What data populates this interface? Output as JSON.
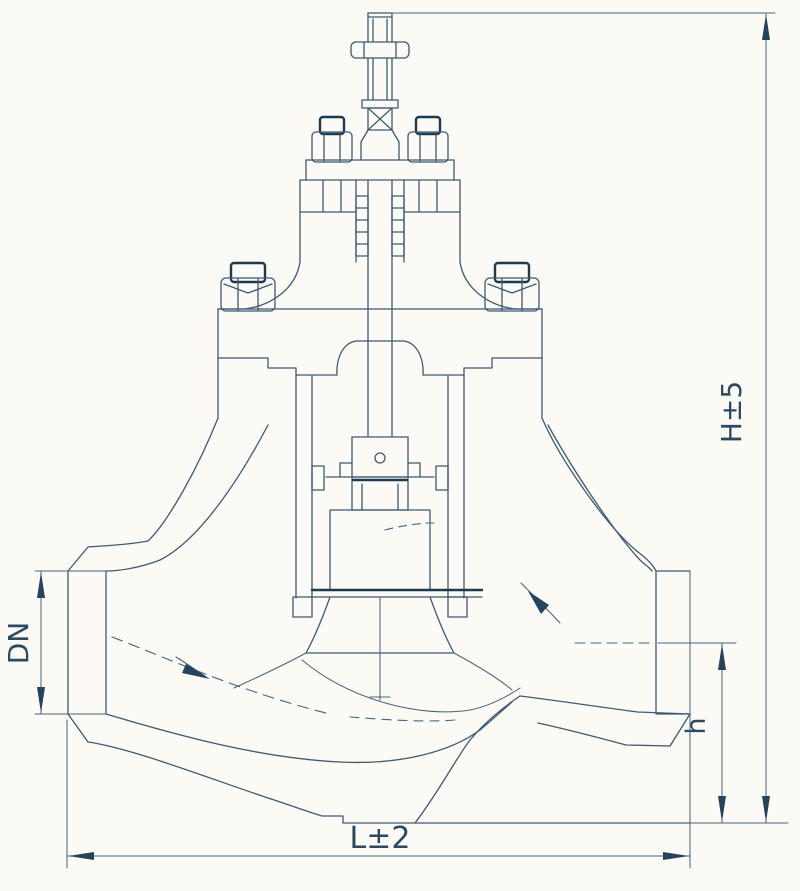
{
  "drawing": {
    "type": "globe-control-valve-cross-section",
    "dimension_labels": {
      "overall_height": "H±5",
      "outlet_center_height": "h",
      "nominal_diameter": "DN",
      "face_to_face_length": "L±2"
    },
    "colors": {
      "line": "#3e5b73",
      "dark_accent": "#1c3a50",
      "text": "#2a4a63",
      "background": "#fbfaf5"
    }
  }
}
